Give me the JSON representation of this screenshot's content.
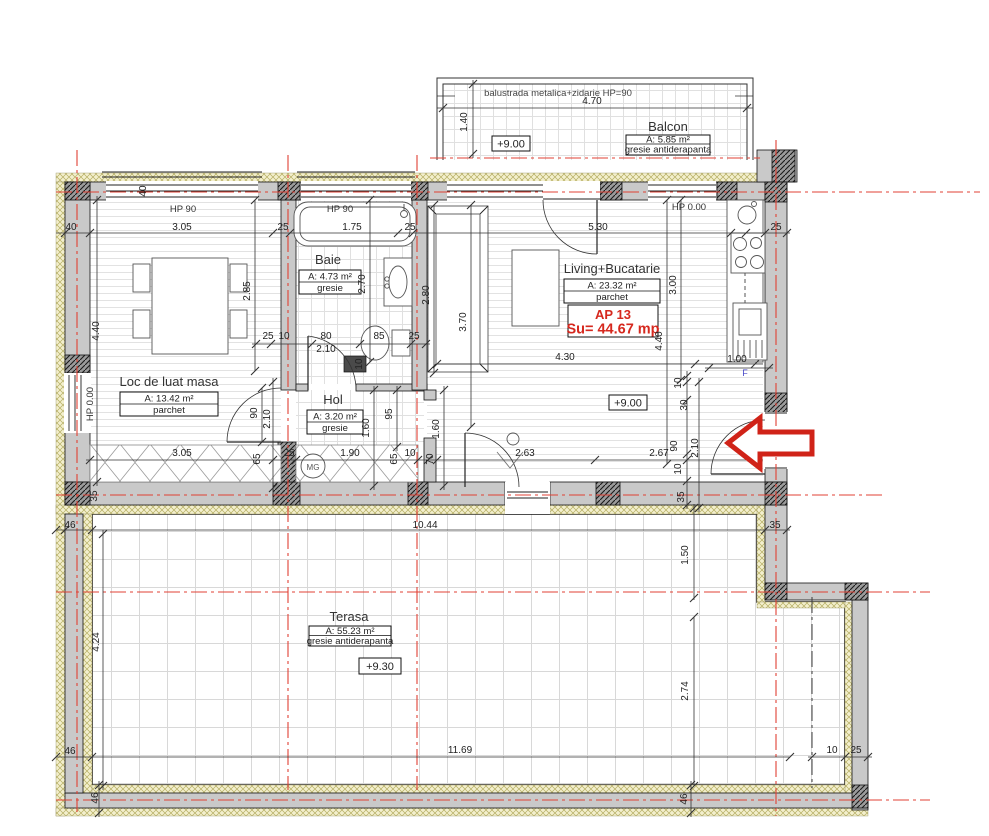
{
  "colors": {
    "accent_red": "#d6281e",
    "axis_red": "#e04134",
    "wall_gray": "#c9c9c9",
    "insulation_yellow": "#f3efcd",
    "fridge_blue": "#4646c8"
  },
  "apartment": {
    "code": "AP 13",
    "surface": "Su= 44.67 mp"
  },
  "rooms": {
    "balcon": {
      "title": "Balcon",
      "area": "A: 5.85 m²",
      "finish": "gresie antiderapanta",
      "level": "+9.00",
      "note": "balustrada metalica+zidarie HP=90"
    },
    "dining": {
      "title": "Loc de luat masa",
      "area": "A: 13.42 m²",
      "finish": "parchet"
    },
    "baie": {
      "title": "Baie",
      "area": "A: 4.73 m²",
      "finish": "gresie"
    },
    "hol": {
      "title": "Hol",
      "area": "A: 3.20 m²",
      "finish": "gresie"
    },
    "living": {
      "title": "Living+Bucatarie",
      "area": "A: 23.32 m²",
      "finish": "parchet",
      "level": "+9.00"
    },
    "terasa": {
      "title": "Terasa",
      "area": "A: 55.23 m²",
      "finish": "gresie antiderapanta",
      "level": "+9.30"
    }
  },
  "markers": {
    "hp90_a": "HP 90",
    "hp90_b": "HP 90",
    "hp0_top": "HP 0.00",
    "hp0_left": "HP 0.00",
    "gas_meter": "MG",
    "fridge": "F"
  },
  "dims": {
    "balcony_width": "4.70",
    "balcony_depth": "1.40",
    "wall40_top": "40",
    "wall40_left": "40",
    "dining_width": "3.05",
    "wall25_a": "25",
    "bath_width": "1.75",
    "wall25_b": "25",
    "living_width": "5.30",
    "wall25_c": "25",
    "dining_height": "2.85",
    "bath_height": "2.70",
    "sofa_depth": "2.80",
    "sofa_length": "3.70",
    "kitchen_height": "3.00",
    "living_height": "4.40",
    "left_height": "4.40",
    "living_inner": "4.30",
    "kitchen_width": "1.00",
    "wall25_d": "25",
    "wall10_a": "10",
    "bathdoor_width": "80",
    "bathdoor_height": "2.10",
    "wc_width": "85",
    "wall25_e": "25",
    "wall10_b": "10",
    "diningdoor_width": "90",
    "diningdoor_height": "2.10",
    "hall_a": "95",
    "hall_b": "1.60",
    "hall_c": "1.60",
    "dining_south": "3.05",
    "seg65_a": "65",
    "wall25_f": "25",
    "hall_south": "1.90",
    "seg65_b": "65",
    "wall10_c": "10",
    "seg70": "70",
    "living_south_a": "2.63",
    "living_south_b": "2.67",
    "ent10_a": "10",
    "ent30": "30",
    "entdoor_width": "90",
    "entdoor_height": "2.10",
    "ent10_b": "10",
    "ent35": "35",
    "wall35_left": "35",
    "terr46_a": "46",
    "terr_top": "10.44",
    "step35": "35",
    "step_depth": "1.50",
    "terr_left": "4.24",
    "terr46_b": "46",
    "terr_bottom": "11.69",
    "terr_right": "2.74",
    "terr10": "10",
    "terr25": "25",
    "terr46_c": "46",
    "terr46_d": "46"
  }
}
